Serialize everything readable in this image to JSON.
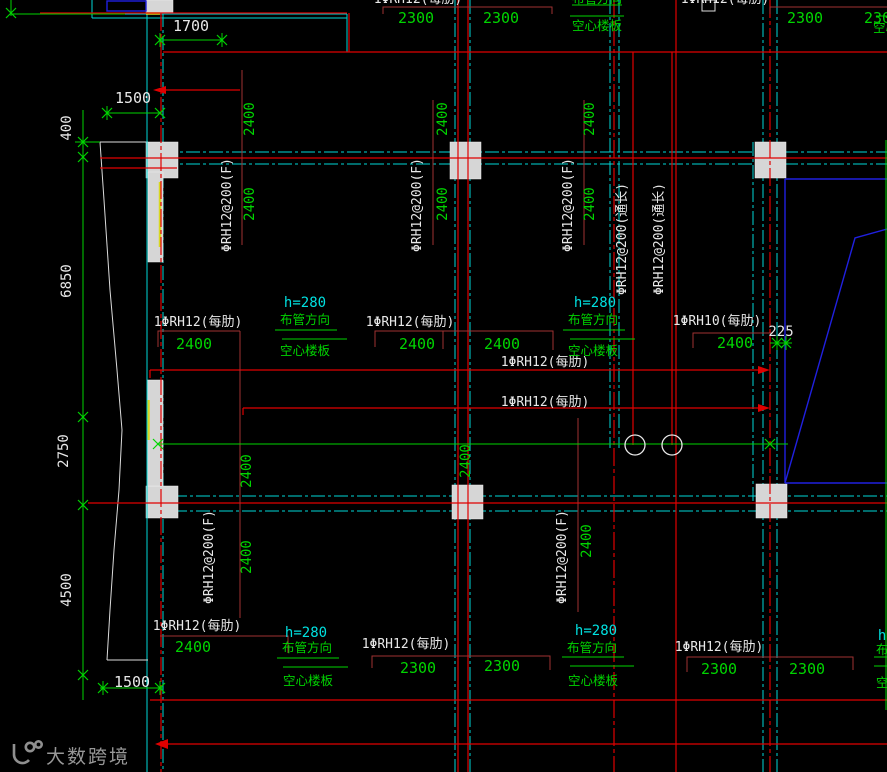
{
  "drawing": {
    "labels": {
      "rib_f": "ΦRH12@200(F)",
      "rib_through": "ΦRH12@200(通长)",
      "rib12": "1ΦRH12(每肋)",
      "rib10": "1ΦRH10(每肋)",
      "h280": "h=280",
      "pipe_dir": "布管方向",
      "hollow": "空心楼板"
    },
    "dims": {
      "d1700": "1700",
      "d1500": "1500",
      "d400": "400",
      "d6850": "6850",
      "d2750": "2750",
      "d4500": "4500",
      "d2400": "2400",
      "d2300": "2300",
      "d225": "225"
    }
  },
  "watermark": {
    "text": "大数跨境",
    "icon": "dashu-logo-icon"
  },
  "colors": {
    "background": "#000000",
    "grid_cyan": "#00d8d8",
    "beam_red": "#e00000",
    "leader_dark_red": "#a03232",
    "dim_green": "#00d400",
    "wall_blue": "#2020e0",
    "text_white": "#e8e8e8",
    "note_cyan": "#00e0e0",
    "column_gray": "#d6d6d6",
    "accent_yellow": "#d8d820",
    "watermark_gray": "#979797"
  }
}
